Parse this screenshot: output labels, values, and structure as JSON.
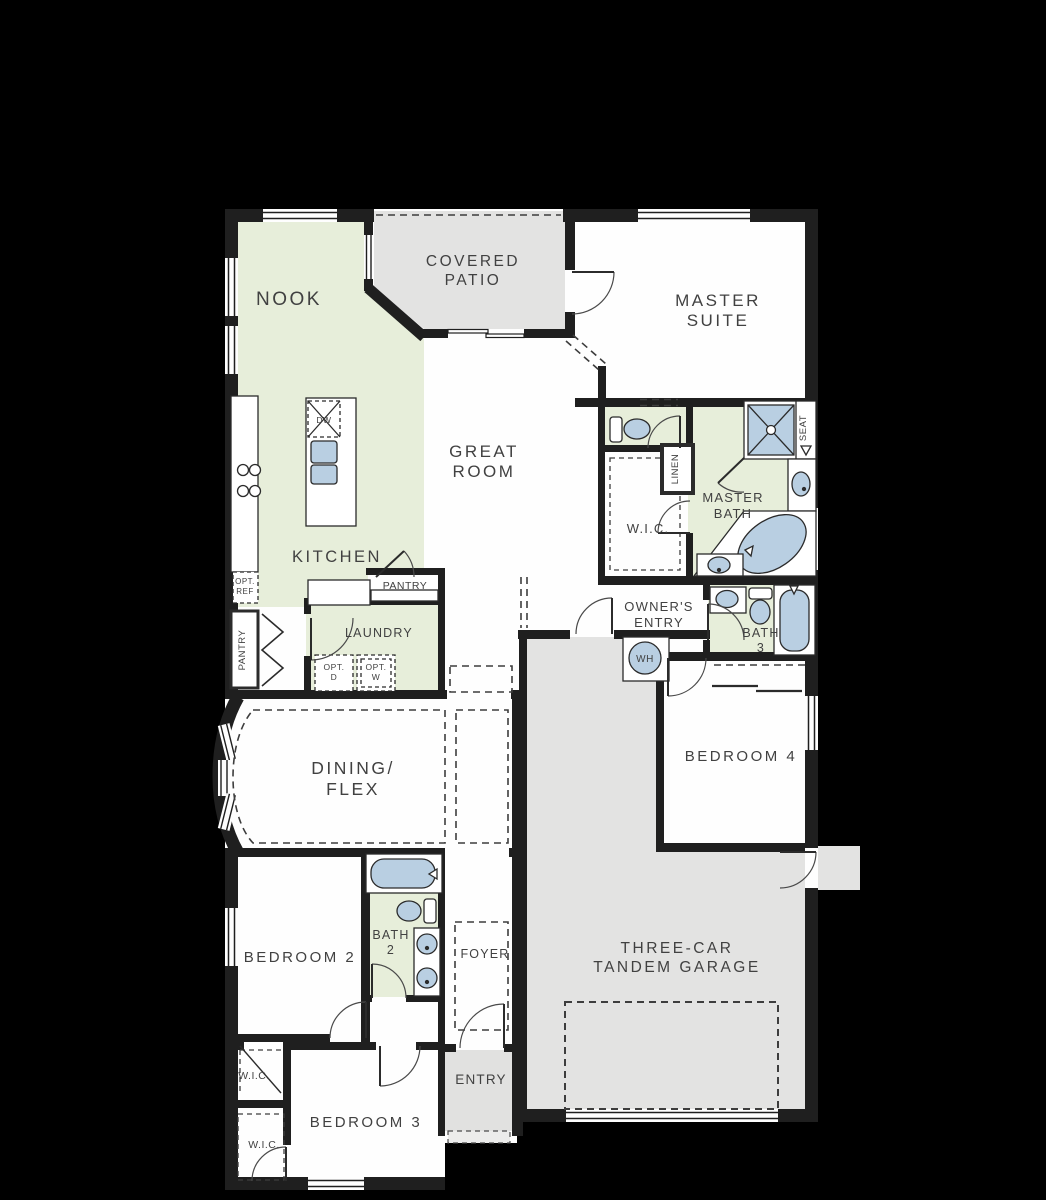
{
  "plan": {
    "type": "single-story-floor-plan",
    "colors": {
      "background": "#000000",
      "wall": "#1f1f1f",
      "floor_white": "#fefefe",
      "floor_green": "#e7eeda",
      "floor_gray": "#e3e3e2",
      "fixture_blue": "#b9cfe2",
      "label_text": "#414141"
    },
    "labels": {
      "nook": "NOOK",
      "covered_patio_1": "COVERED",
      "covered_patio_2": "PATIO",
      "master_suite_1": "MASTER",
      "master_suite_2": "SUITE",
      "great_room_1": "GREAT",
      "great_room_2": "ROOM",
      "kitchen": "KITCHEN",
      "master_bath_1": "MASTER",
      "master_bath_2": "BATH",
      "wic_master": "W.I.C.",
      "linen": "LINEN",
      "seat": "SEAT",
      "pantry_walkin": "PANTRY",
      "pantry_cabinet": "PANTRY",
      "laundry": "LAUNDRY",
      "opt_ref_1": "OPT.",
      "opt_ref_2": "REF",
      "opt_d_1": "OPT.",
      "opt_d_2": "D",
      "opt_w_1": "OPT.",
      "opt_w_2": "W",
      "dw": "DW",
      "wh": "WH",
      "owners_entry_1": "OWNER'S",
      "owners_entry_2": "ENTRY",
      "bath3_1": "BATH",
      "bath3_2": "3",
      "bedroom4": "BEDROOM 4",
      "dining_1": "DINING/",
      "dining_2": "FLEX",
      "bedroom2": "BEDROOM 2",
      "bath2_1": "BATH",
      "bath2_2": "2",
      "foyer": "FOYER",
      "garage_1": "THREE-CAR",
      "garage_2": "TANDEM GARAGE",
      "wic_bedroom2": "W.I.C.",
      "bedroom3": "BEDROOM 3",
      "wic_bedroom3": "W.I.C.",
      "entry": "ENTRY"
    }
  }
}
